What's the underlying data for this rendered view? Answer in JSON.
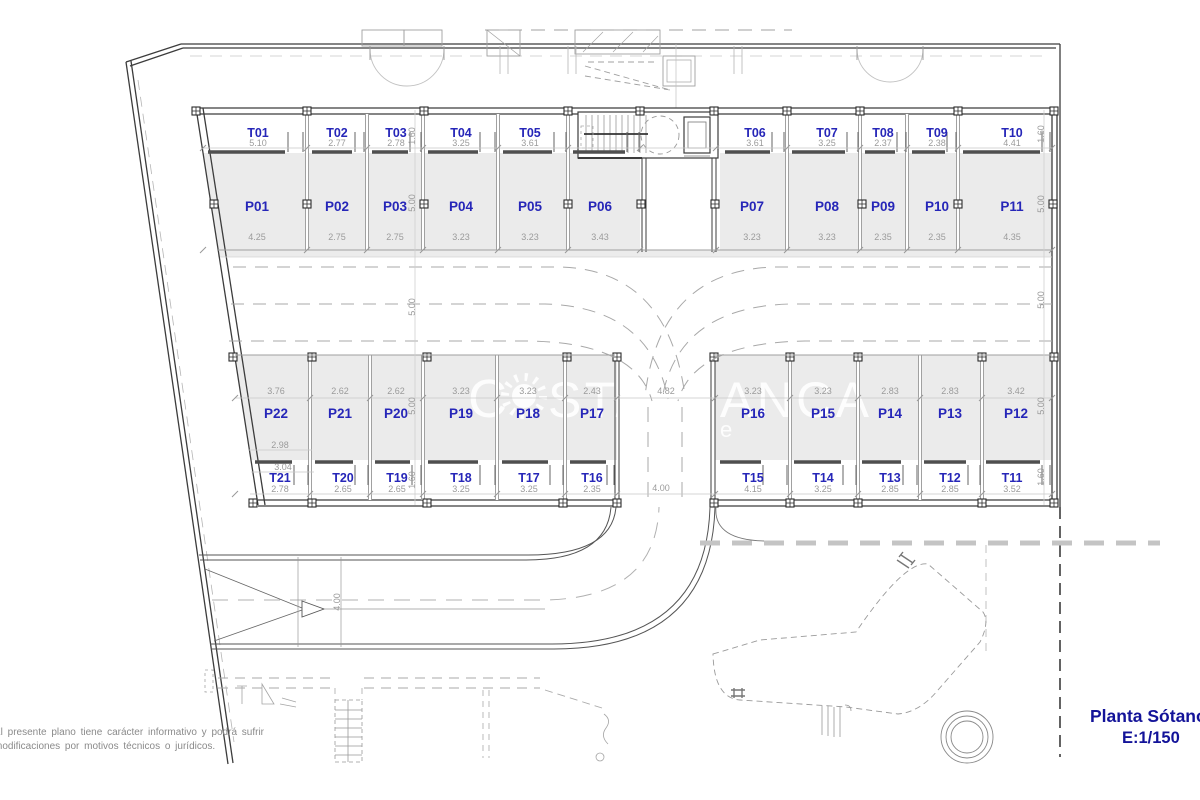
{
  "title_block": {
    "title": "Planta Sótano",
    "scale": "E:1/150"
  },
  "disclaimer": {
    "line1": "El presente plano tiene carácter informativo y podrá sufrir",
    "line2": "modificaciones por motivos técnicos o jurídicos."
  },
  "watermark": {
    "prefix": "C",
    "body": "STABLANCA",
    "suffix": "e"
  },
  "plan": {
    "storage_top": [
      {
        "id": "T01",
        "width": "5.10"
      },
      {
        "id": "T02",
        "width": "2.77"
      },
      {
        "id": "T03",
        "width": "2.78"
      },
      {
        "id": "T04",
        "width": "3.25"
      },
      {
        "id": "T05",
        "width": "3.61"
      },
      {
        "id": "T06",
        "width": "3.61"
      },
      {
        "id": "T07",
        "width": "3.25"
      },
      {
        "id": "T08",
        "width": "2.37"
      },
      {
        "id": "T09",
        "width": "2.38"
      },
      {
        "id": "T10",
        "width": "4.41"
      }
    ],
    "parking_top": [
      {
        "id": "P01",
        "width": "4.25"
      },
      {
        "id": "P02",
        "width": "2.75"
      },
      {
        "id": "P03",
        "width": "2.75"
      },
      {
        "id": "P04",
        "width": "3.23"
      },
      {
        "id": "P05",
        "width": "3.23"
      },
      {
        "id": "P06",
        "width": "3.43"
      },
      {
        "id": "P07",
        "width": "3.23"
      },
      {
        "id": "P08",
        "width": "3.23"
      },
      {
        "id": "P09",
        "width": "2.35"
      },
      {
        "id": "P10",
        "width": "2.35"
      },
      {
        "id": "P11",
        "width": "4.35"
      }
    ],
    "parking_bottom": [
      {
        "id": "P22",
        "width": "3.76"
      },
      {
        "id": "P21",
        "width": "2.62"
      },
      {
        "id": "P20",
        "width": "2.62"
      },
      {
        "id": "P19",
        "width": "3.23"
      },
      {
        "id": "P18",
        "width": "3.23"
      },
      {
        "id": "P17",
        "width": "2.43"
      },
      {
        "id": "P16",
        "width": "3.23"
      },
      {
        "id": "P15",
        "width": "3.23"
      },
      {
        "id": "P14",
        "width": "2.83"
      },
      {
        "id": "P13",
        "width": "2.83"
      },
      {
        "id": "P12",
        "width": "3.42"
      }
    ],
    "storage_bottom": [
      {
        "id": "T21",
        "width": "2.78"
      },
      {
        "id": "T20",
        "width": "2.65"
      },
      {
        "id": "T19",
        "width": "2.65"
      },
      {
        "id": "T18",
        "width": "3.25"
      },
      {
        "id": "T17",
        "width": "3.25"
      },
      {
        "id": "T16",
        "width": "2.35"
      },
      {
        "id": "T15",
        "width": "4.15"
      },
      {
        "id": "T14",
        "width": "3.25"
      },
      {
        "id": "T13",
        "width": "2.85"
      },
      {
        "id": "T12",
        "width": "2.85"
      },
      {
        "id": "T11",
        "width": "3.52"
      }
    ],
    "left_dims": [
      "1.60",
      "5.00",
      "5.00",
      "5.00",
      "1.60"
    ],
    "right_dims": [
      "1.60",
      "5.00",
      "5.00",
      "5.00",
      "1.60"
    ],
    "extra_dims": {
      "p22_lower": "2.98",
      "t21_upper": "3.04",
      "ramp_width": "4.82",
      "ramp_entry": "4.00",
      "driveway_width": "4.00"
    }
  },
  "colors": {
    "label_blue": "#2626b8",
    "dim_gray": "#9b9b9b",
    "fill_gray": "#ebebeb",
    "wall_dark": "#3c3c3c",
    "title_navy": "#131399"
  }
}
